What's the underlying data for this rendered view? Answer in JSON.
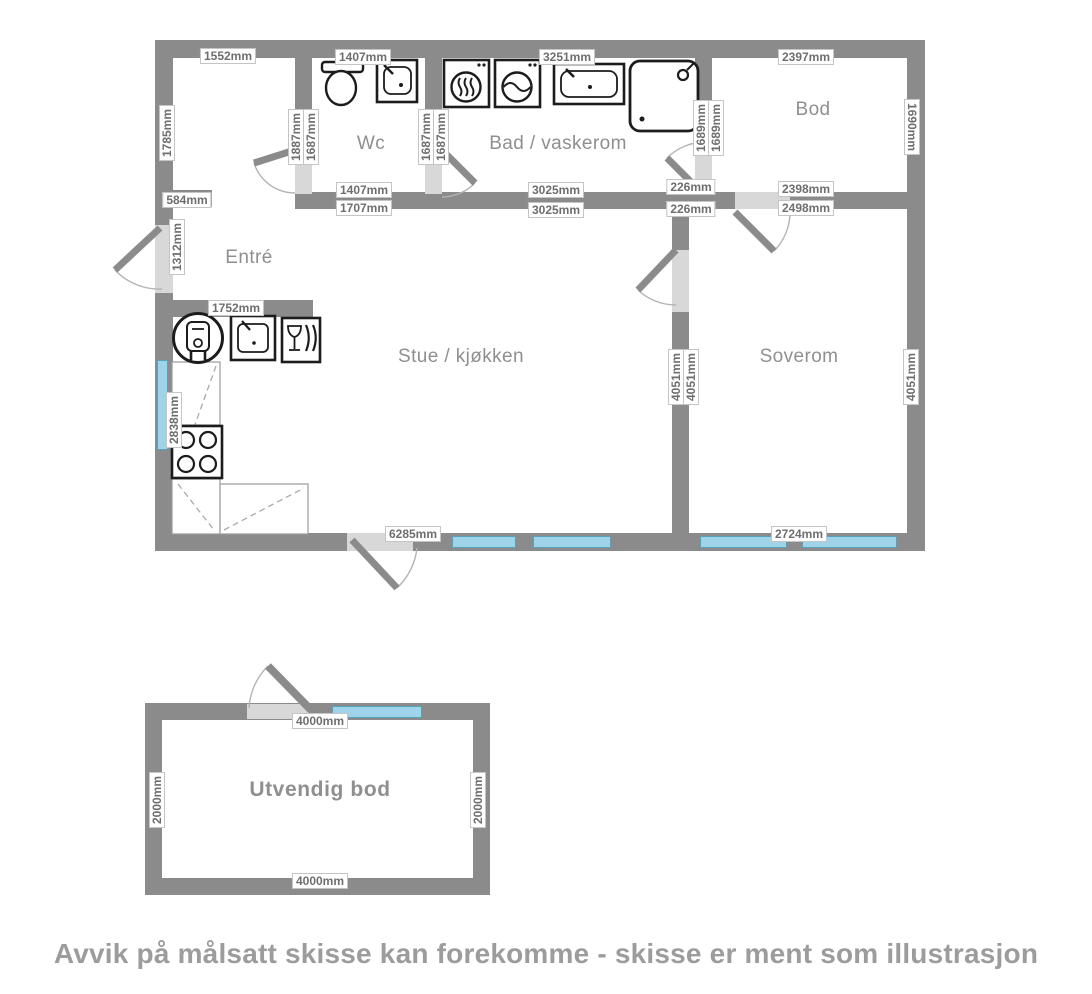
{
  "title": "Floor plan sketch",
  "colors": {
    "wall": "#8b8b8b",
    "door_opening": "#d8d8d8",
    "window_fill": "#9fd3e8",
    "window_border": "#58a0bf",
    "dimension_text": "#6e6e6e",
    "room_text": "#8f8f8f",
    "caption_text": "#9c9c9c"
  },
  "rooms": {
    "wc": "Wc",
    "bad": "Bad / vaskerom",
    "bod": "Bod",
    "entre": "Entré",
    "stue": "Stue / kjøkken",
    "soverom": "Soverom",
    "utvendig_bod": "Utvendig bod"
  },
  "dims": [
    "1552mm",
    "1785mm",
    "584mm",
    "1312mm",
    "1407mm",
    "1887mm",
    "1687mm",
    "1687mm",
    "1687mm",
    "3251mm",
    "1689mm",
    "1689mm",
    "2397mm",
    "1690mm",
    "1407mm",
    "1707mm",
    "3025mm",
    "3025mm",
    "226mm",
    "226mm",
    "2398mm",
    "2498mm",
    "1752mm",
    "2838mm",
    "4051mm",
    "4051mm",
    "4051mm",
    "6285mm",
    "2724mm",
    "4000mm",
    "2000mm",
    "2000mm",
    "4000mm"
  ],
  "caption": "Avvik på målsatt skisse kan forekomme - skisse er ment som illustrasjon",
  "icons": [
    "toilet-icon",
    "wc-sink-icon",
    "dryer-icon",
    "washing-machine-icon",
    "bathroom-sink-icon",
    "shower-icon",
    "water-heater-icon",
    "kitchen-sink-icon",
    "dishwasher-icon",
    "stove-icon"
  ]
}
